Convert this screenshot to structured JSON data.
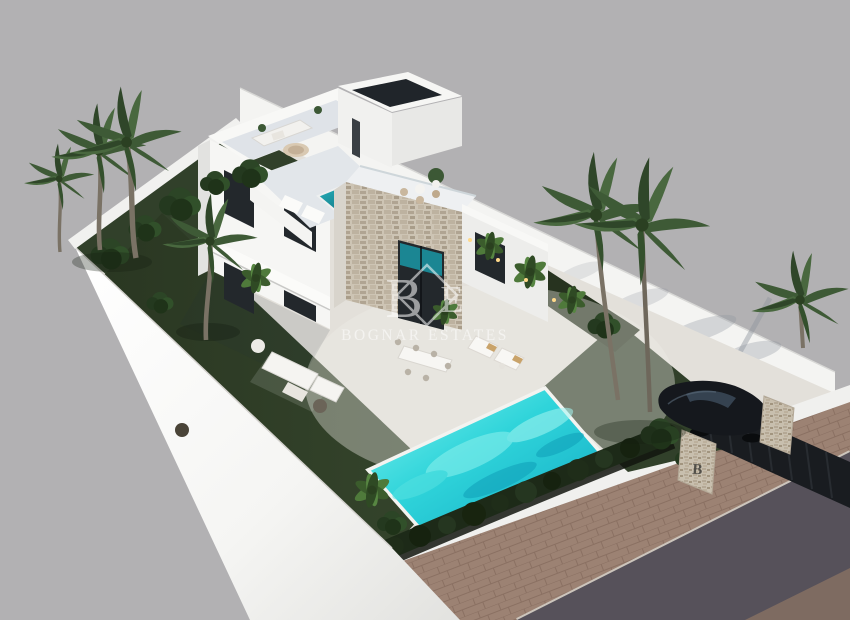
{
  "watermark": {
    "monogram_primary": "B",
    "monogram_secondary": "E",
    "text": "BOGNAR ESTATES"
  },
  "entrance_sign": {
    "letter": "B"
  },
  "colors": {
    "background": "#b2b1b3",
    "wall_white": "#f4f4f2",
    "deck": "#e3e0da",
    "plinth_white": "#fafaf8",
    "lawn": "#31402a",
    "lawn_dark": "#27331f",
    "hedge": "#1d2a18",
    "pool_light": "#6ceeec",
    "pool_deep": "#12aac4",
    "plunge_pool": "#1e9aa8",
    "stone": "#cdc4b4",
    "sidewalk": "#9c8273",
    "road": "#56515a",
    "car": "#15181d",
    "glass": "#23282c",
    "palm": "#3e5a36",
    "watermark_white": "#ffffff"
  }
}
